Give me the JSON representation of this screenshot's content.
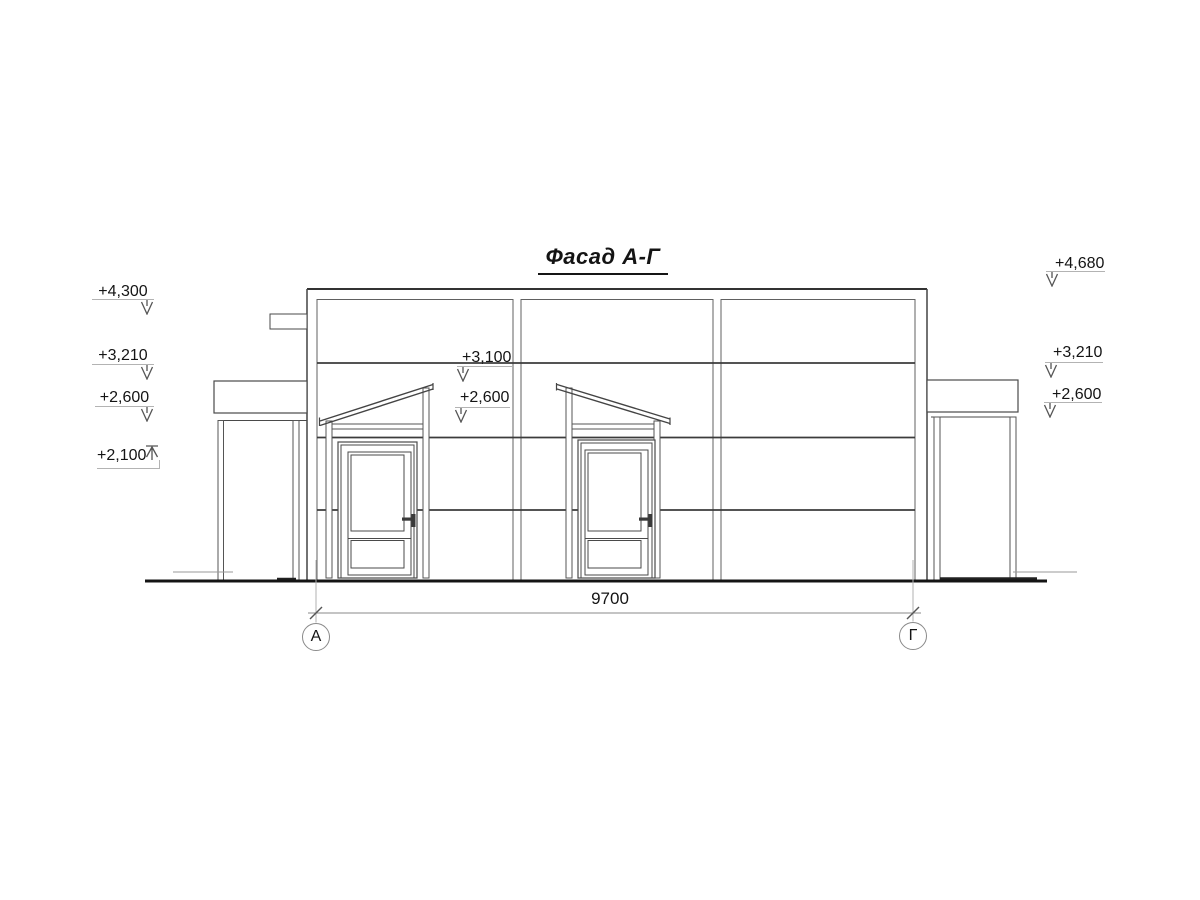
{
  "drawing": {
    "title": "Фасад А-Г",
    "dimension_label": "9700",
    "axis_left": "А",
    "axis_right": "Г",
    "elevations": {
      "left": [
        "+4,300",
        "+3,210",
        "+2,600",
        "+2,100"
      ],
      "center": [
        "+3,100",
        "+2,600"
      ],
      "right": [
        "+4,680",
        "+3,210",
        "+2,600"
      ]
    },
    "colors": {
      "outline": "#3c3c3c",
      "thin_line": "#606060",
      "ground": "#141414",
      "annotation": "#b3b3b3"
    }
  }
}
